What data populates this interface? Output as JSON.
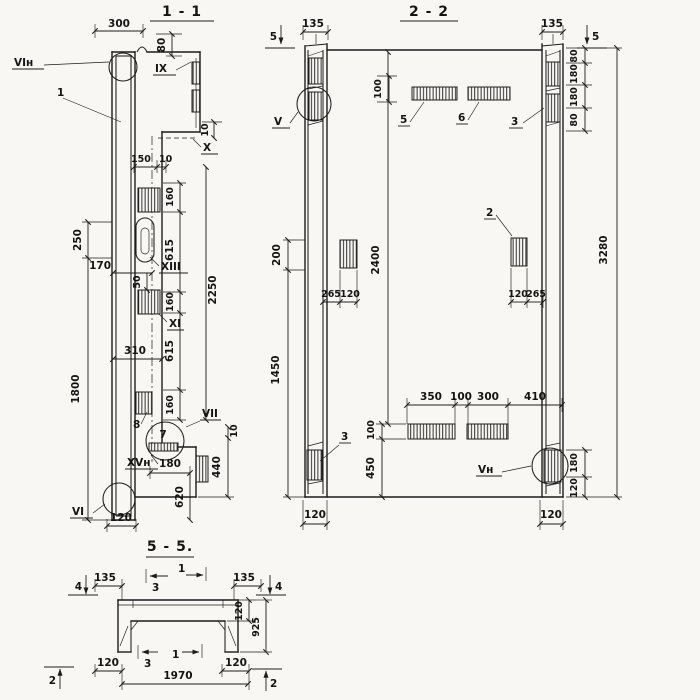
{
  "page": {
    "background": "#f8f7f3",
    "ink": "#1c1c1c"
  },
  "s11": {
    "title": "1 - 1",
    "labels": {
      "node_top": "VIн",
      "pos_1": "1",
      "ix": "IX",
      "x": "X",
      "xiii": "XIII",
      "xi": "XI",
      "vii": "VII",
      "pos_8": "8",
      "pos_7": "7",
      "xvn": "XVн",
      "node_bottom": "VI"
    },
    "dims": {
      "w300": "300",
      "h80": "80",
      "step10": "10",
      "inner150": "150",
      "inner10": "10",
      "left250": "250",
      "left1800": "1800",
      "off170": "170",
      "off50": "50",
      "off310": "310",
      "chain160a": "160",
      "chain615a": "615",
      "chain160b": "160",
      "chain615b": "615",
      "chain160c": "160",
      "total2250": "2250",
      "low10": "10",
      "low440": "440",
      "low620": "620",
      "low180": "180",
      "low120": "120"
    }
  },
  "s22": {
    "title": "2 - 2",
    "labels": {
      "v": "V",
      "pos_5": "5",
      "pos_6": "6",
      "pos_3_top": "3",
      "pos_2": "2",
      "pos_3_bottom": "3",
      "vn": "Vн"
    },
    "markers": {
      "cut5_left": "5",
      "cut5_right": "5"
    },
    "dims": {
      "top135_left": "135",
      "top135_right": "135",
      "top100": "100",
      "r80a": "80",
      "r180a": "180",
      "r180b": "180",
      "r80b": "80",
      "total3280": "3280",
      "inner2400": "2400",
      "left200": "200",
      "left1450": "1450",
      "lp265": "265",
      "lp120": "120",
      "rp120": "120",
      "rp265": "265",
      "b350": "350",
      "b100gap": "100",
      "b300": "300",
      "b410": "410",
      "b100": "100",
      "b450": "450",
      "rb180": "180",
      "rb120": "120",
      "col120_left": "120",
      "col120_right": "120"
    }
  },
  "s55": {
    "title": "5 - 5.",
    "markers": {
      "cut4_left": "4",
      "cut4_right": "4",
      "cut3_top": "3",
      "cut1_top": "1",
      "cut3_bottom": "3",
      "cut1_bottom": "1",
      "cut2_left": "2",
      "cut2_right": "2"
    },
    "dims": {
      "f135_left": "135",
      "f135_right": "135",
      "web120": "120",
      "depth925": "925",
      "leg120_left": "120",
      "leg120_right": "120",
      "clear1970": "1970"
    }
  }
}
